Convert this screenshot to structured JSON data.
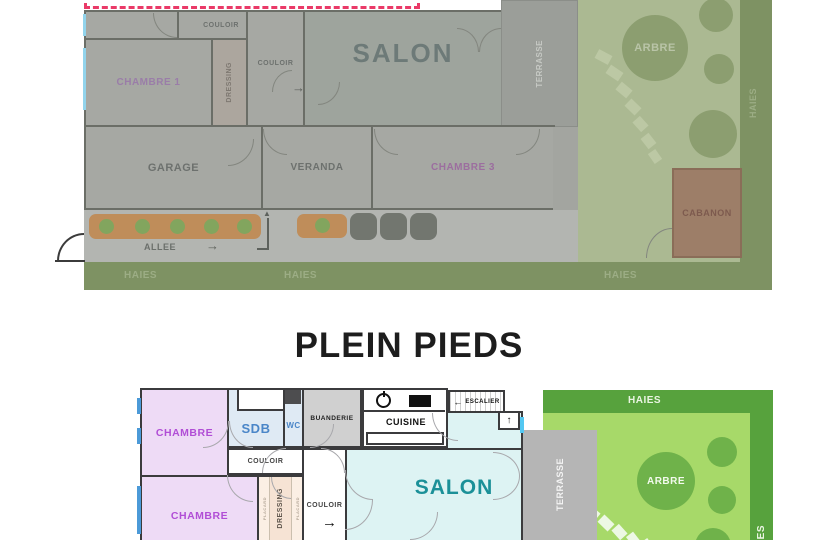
{
  "title": "PLEIN PIEDS",
  "icons": {
    "arrow_right": "→",
    "arrow_left": "←",
    "arrow_up": "↑"
  },
  "plan_top": {
    "couloir_top": "COULOIR",
    "couloir_mid": "COULOIR",
    "chambre1": "CHAMBRE 1",
    "dressing": "DRESSING",
    "salon": "SALON",
    "terrasse": "TERRASSE",
    "garage": "GARAGE",
    "veranda": "VERANDA",
    "chambre3": "CHAMBRE 3",
    "allee": "ALLEE",
    "haies_bottom_1": "HAIES",
    "haies_bottom_2": "HAIES",
    "haies_bottom_3": "HAIES",
    "haies_right": "HAIES",
    "arbre": "ARBRE",
    "cabanon": "CABANON"
  },
  "plan_bottom": {
    "chambre_a": "CHAMBRE",
    "chambre_b": "CHAMBRE",
    "sdb": "SDB",
    "wc": "WC",
    "buanderie": "BUANDERIE",
    "cuisine": "CUISINE",
    "escalier": "ESCALIER",
    "couloir_h": "COULOIR",
    "couloir_v": "COULOIR",
    "dressing": "DRESSING",
    "placard_left": "PLACARD",
    "placard_right": "PLACARD",
    "salon": "SALON",
    "terrasse": "TERRASSE",
    "haies_top": "HAIES",
    "haies_right": "HAIES",
    "arbre": "ARBRE"
  },
  "colors": {
    "selection_dash": "#ea3a68",
    "faded_wall": "#6b6e67",
    "wall": "#3b3b3d",
    "chambre_fill": "#eedbf6",
    "chambre_text": "#b14ed6",
    "bath_fill": "#dfeaf4",
    "bath_text": "#4a86c8",
    "salon_fill": "#ddf3f3",
    "salon_text": "#1b9098",
    "garden": "#a7d969",
    "hedge": "#57a23d",
    "tree": "#6fb24a",
    "terrasse_fill": "#b5b5b5",
    "dressing_fill": "#f6e3d4",
    "window_blue": "#4b9ad8",
    "window_cyan": "#54c8f2"
  }
}
